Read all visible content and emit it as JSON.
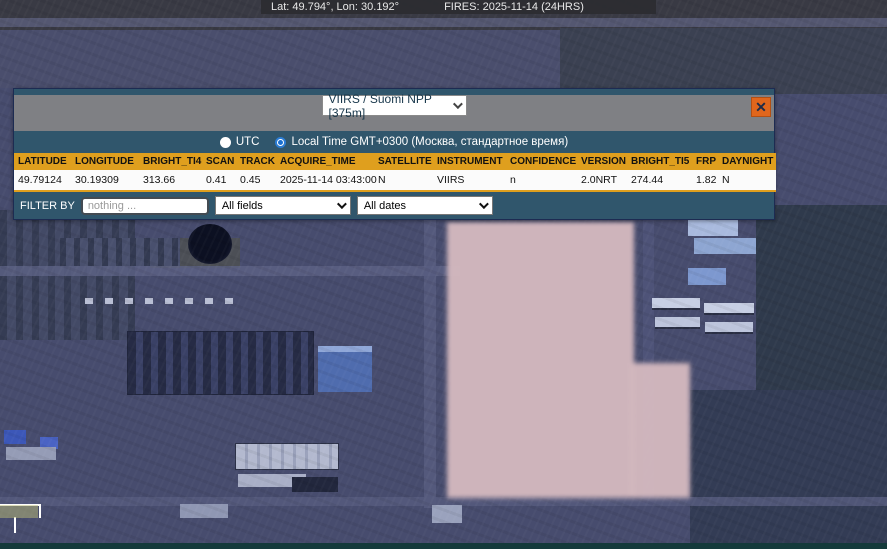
{
  "status_bar": {
    "coords": "Lat: 49.794°, Lon: 30.192°",
    "fires": "FIRES: 2025-11-14 (24HRS)"
  },
  "popup": {
    "source_select": {
      "value": "VIIRS / Suomi NPP [375m]"
    },
    "close_label": "✕",
    "time_toggle": {
      "utc_label": "UTC",
      "local_label": "Local Time GMT+0300 (Москва, стандартное время)",
      "selected": "local"
    },
    "table": {
      "headers": [
        "LATITUDE",
        "LONGITUDE",
        "BRIGHT_TI4",
        "SCAN",
        "TRACK",
        "ACQUIRE_TIME",
        "SATELLITE",
        "INSTRUMENT",
        "CONFIDENCE",
        "VERSION",
        "BRIGHT_TI5",
        "FRP",
        "DAYNIGHT"
      ],
      "rows": [
        [
          "49.79124",
          "30.19309",
          "313.66",
          "0.41",
          "0.45",
          "2025-11-14 03:43:00",
          "N",
          "VIIRS",
          "n",
          "2.0NRT",
          "274.44",
          "1.82",
          "N"
        ]
      ]
    },
    "filter": {
      "label": "FILTER BY",
      "input_placeholder": "nothing ...",
      "fields_value": "All fields",
      "dates_value": "All dates"
    }
  },
  "colors": {
    "header_orange": "#DF9F1E",
    "panel_teal": "#30566C",
    "close_orange": "#E0661C",
    "fire_footprint_pink": "#D3B8BE",
    "status_bar_bg": "#2C2C32"
  }
}
